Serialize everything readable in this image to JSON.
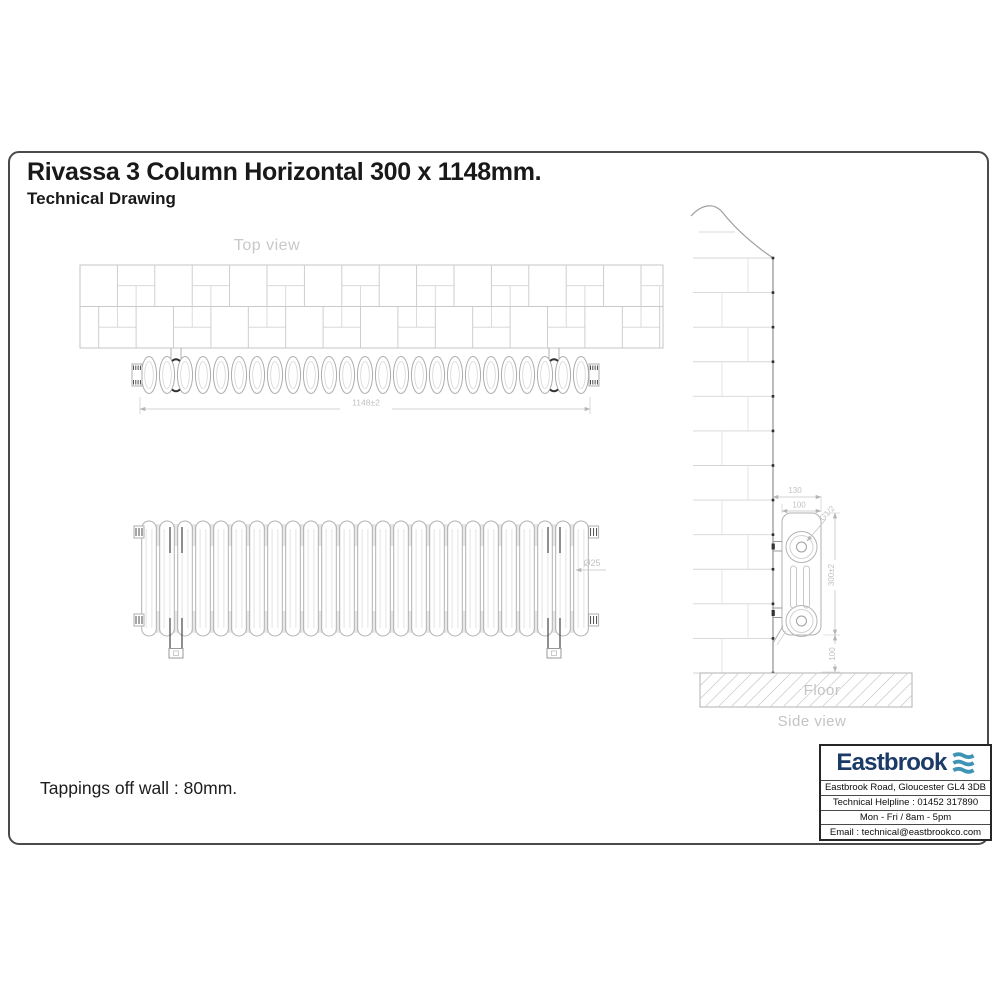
{
  "page": {
    "title": "Rivassa 3 Column Horizontal 300 x 1148mm.",
    "subtitle": "Technical Drawing",
    "note": "Tappings off wall : 80mm."
  },
  "drawing": {
    "labels": {
      "top_view": "Top view",
      "side_view": "Side view",
      "floor": "Floor"
    },
    "sections": 25,
    "dims": {
      "overall_width": "1148±2",
      "column_diameter": "Ø25",
      "wall_to_front": "130",
      "depth": "100",
      "tapping_thread": "G1/2",
      "height": "300±2",
      "floor_to_bottom": "100"
    }
  },
  "infobox": {
    "brand": "Eastbrook",
    "lines": [
      "Eastbrook Road, Gloucester GL4 3DB",
      "Technical Helpline : 01452 317890",
      "Mon - Fri / 8am - 5pm",
      "Email : technical@eastbrookco.com"
    ],
    "brand_color": "#1c3a66",
    "wave_color": "#3f93b5"
  }
}
